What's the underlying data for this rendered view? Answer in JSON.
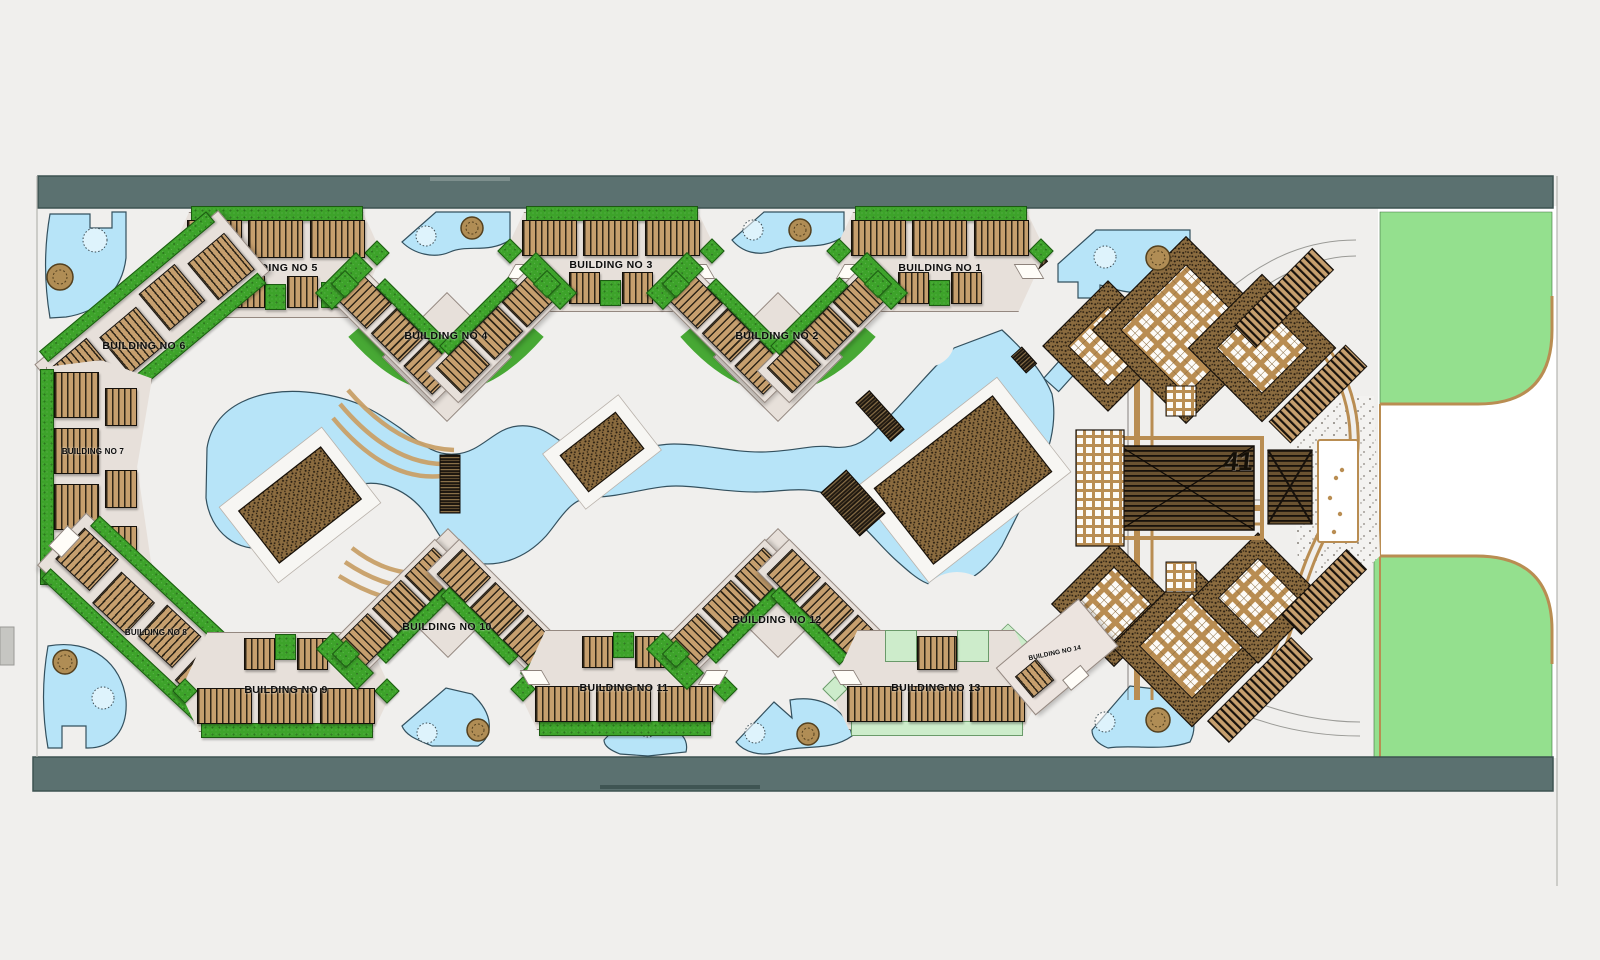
{
  "buildings": [
    {
      "id": "b1",
      "label": "BUILDING NO 1"
    },
    {
      "id": "b2",
      "label": "BUILDING NO 2"
    },
    {
      "id": "b3",
      "label": "BUILDING NO 3"
    },
    {
      "id": "b4",
      "label": "BUILDING NO 4"
    },
    {
      "id": "b5",
      "label": "BUILDING NO 5"
    },
    {
      "id": "b6",
      "label": "BUILDING NO 6"
    },
    {
      "id": "b7",
      "label": "BUILDING NO 7"
    },
    {
      "id": "b8",
      "label": "BUILDING NO 8"
    },
    {
      "id": "b9",
      "label": "BUILDING NO 9"
    },
    {
      "id": "b10",
      "label": "BUILDING NO 10"
    },
    {
      "id": "b11",
      "label": "BUILDING NO 11"
    },
    {
      "id": "b12",
      "label": "BUILDING NO 12"
    },
    {
      "id": "b13",
      "label": "BUILDING NO 13"
    },
    {
      "id": "b14",
      "label": "BUILDING NO 14"
    }
  ],
  "main_hall_label": "41",
  "colors": {
    "page": "#f0efed",
    "road": "#5b7170",
    "water": "#b7e4f8",
    "grass": "#3da32a",
    "lawn": "#94e08e",
    "plot": "#e7e0da",
    "rooftan": "#c69f6e",
    "pale": "#cdeccb",
    "path": "#c9a169"
  }
}
